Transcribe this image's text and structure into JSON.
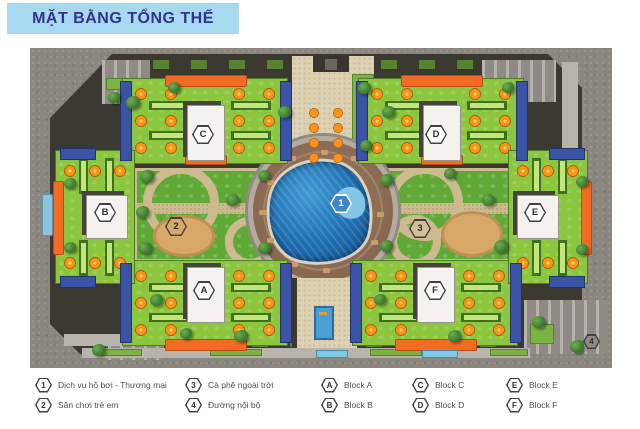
{
  "title": "MẶT BẰNG TỔNG THỂ",
  "legend": {
    "items": [
      {
        "symbol": "1",
        "label": "Dịch vụ hồ bơi - Thương mại"
      },
      {
        "symbol": "2",
        "label": "Sân chơi trẻ em"
      },
      {
        "symbol": "3",
        "label": "Cà phê ngoài trời"
      },
      {
        "symbol": "4",
        "label": "Đường nội bộ"
      },
      {
        "symbol": "A",
        "label": "Block A"
      },
      {
        "symbol": "B",
        "label": "Block B"
      },
      {
        "symbol": "C",
        "label": "Block C"
      },
      {
        "symbol": "D",
        "label": "Block D"
      },
      {
        "symbol": "E",
        "label": "Block E"
      },
      {
        "symbol": "F",
        "label": "Block F"
      }
    ]
  },
  "colors": {
    "banner_bg": "#a6d8f0",
    "banner_text": "#33338b",
    "asphalt": "#8b867f",
    "roof_green": "#8cc63f",
    "accent_orange": "#f26c23",
    "accent_blue": "#3a53a4",
    "umbrella_orange": "#f7941d",
    "pool_blue": "#1d6db1",
    "plaza_brown": "#8b6a53",
    "path_tan": "#cdbb8f",
    "legend_text": "#4d4d4f"
  }
}
